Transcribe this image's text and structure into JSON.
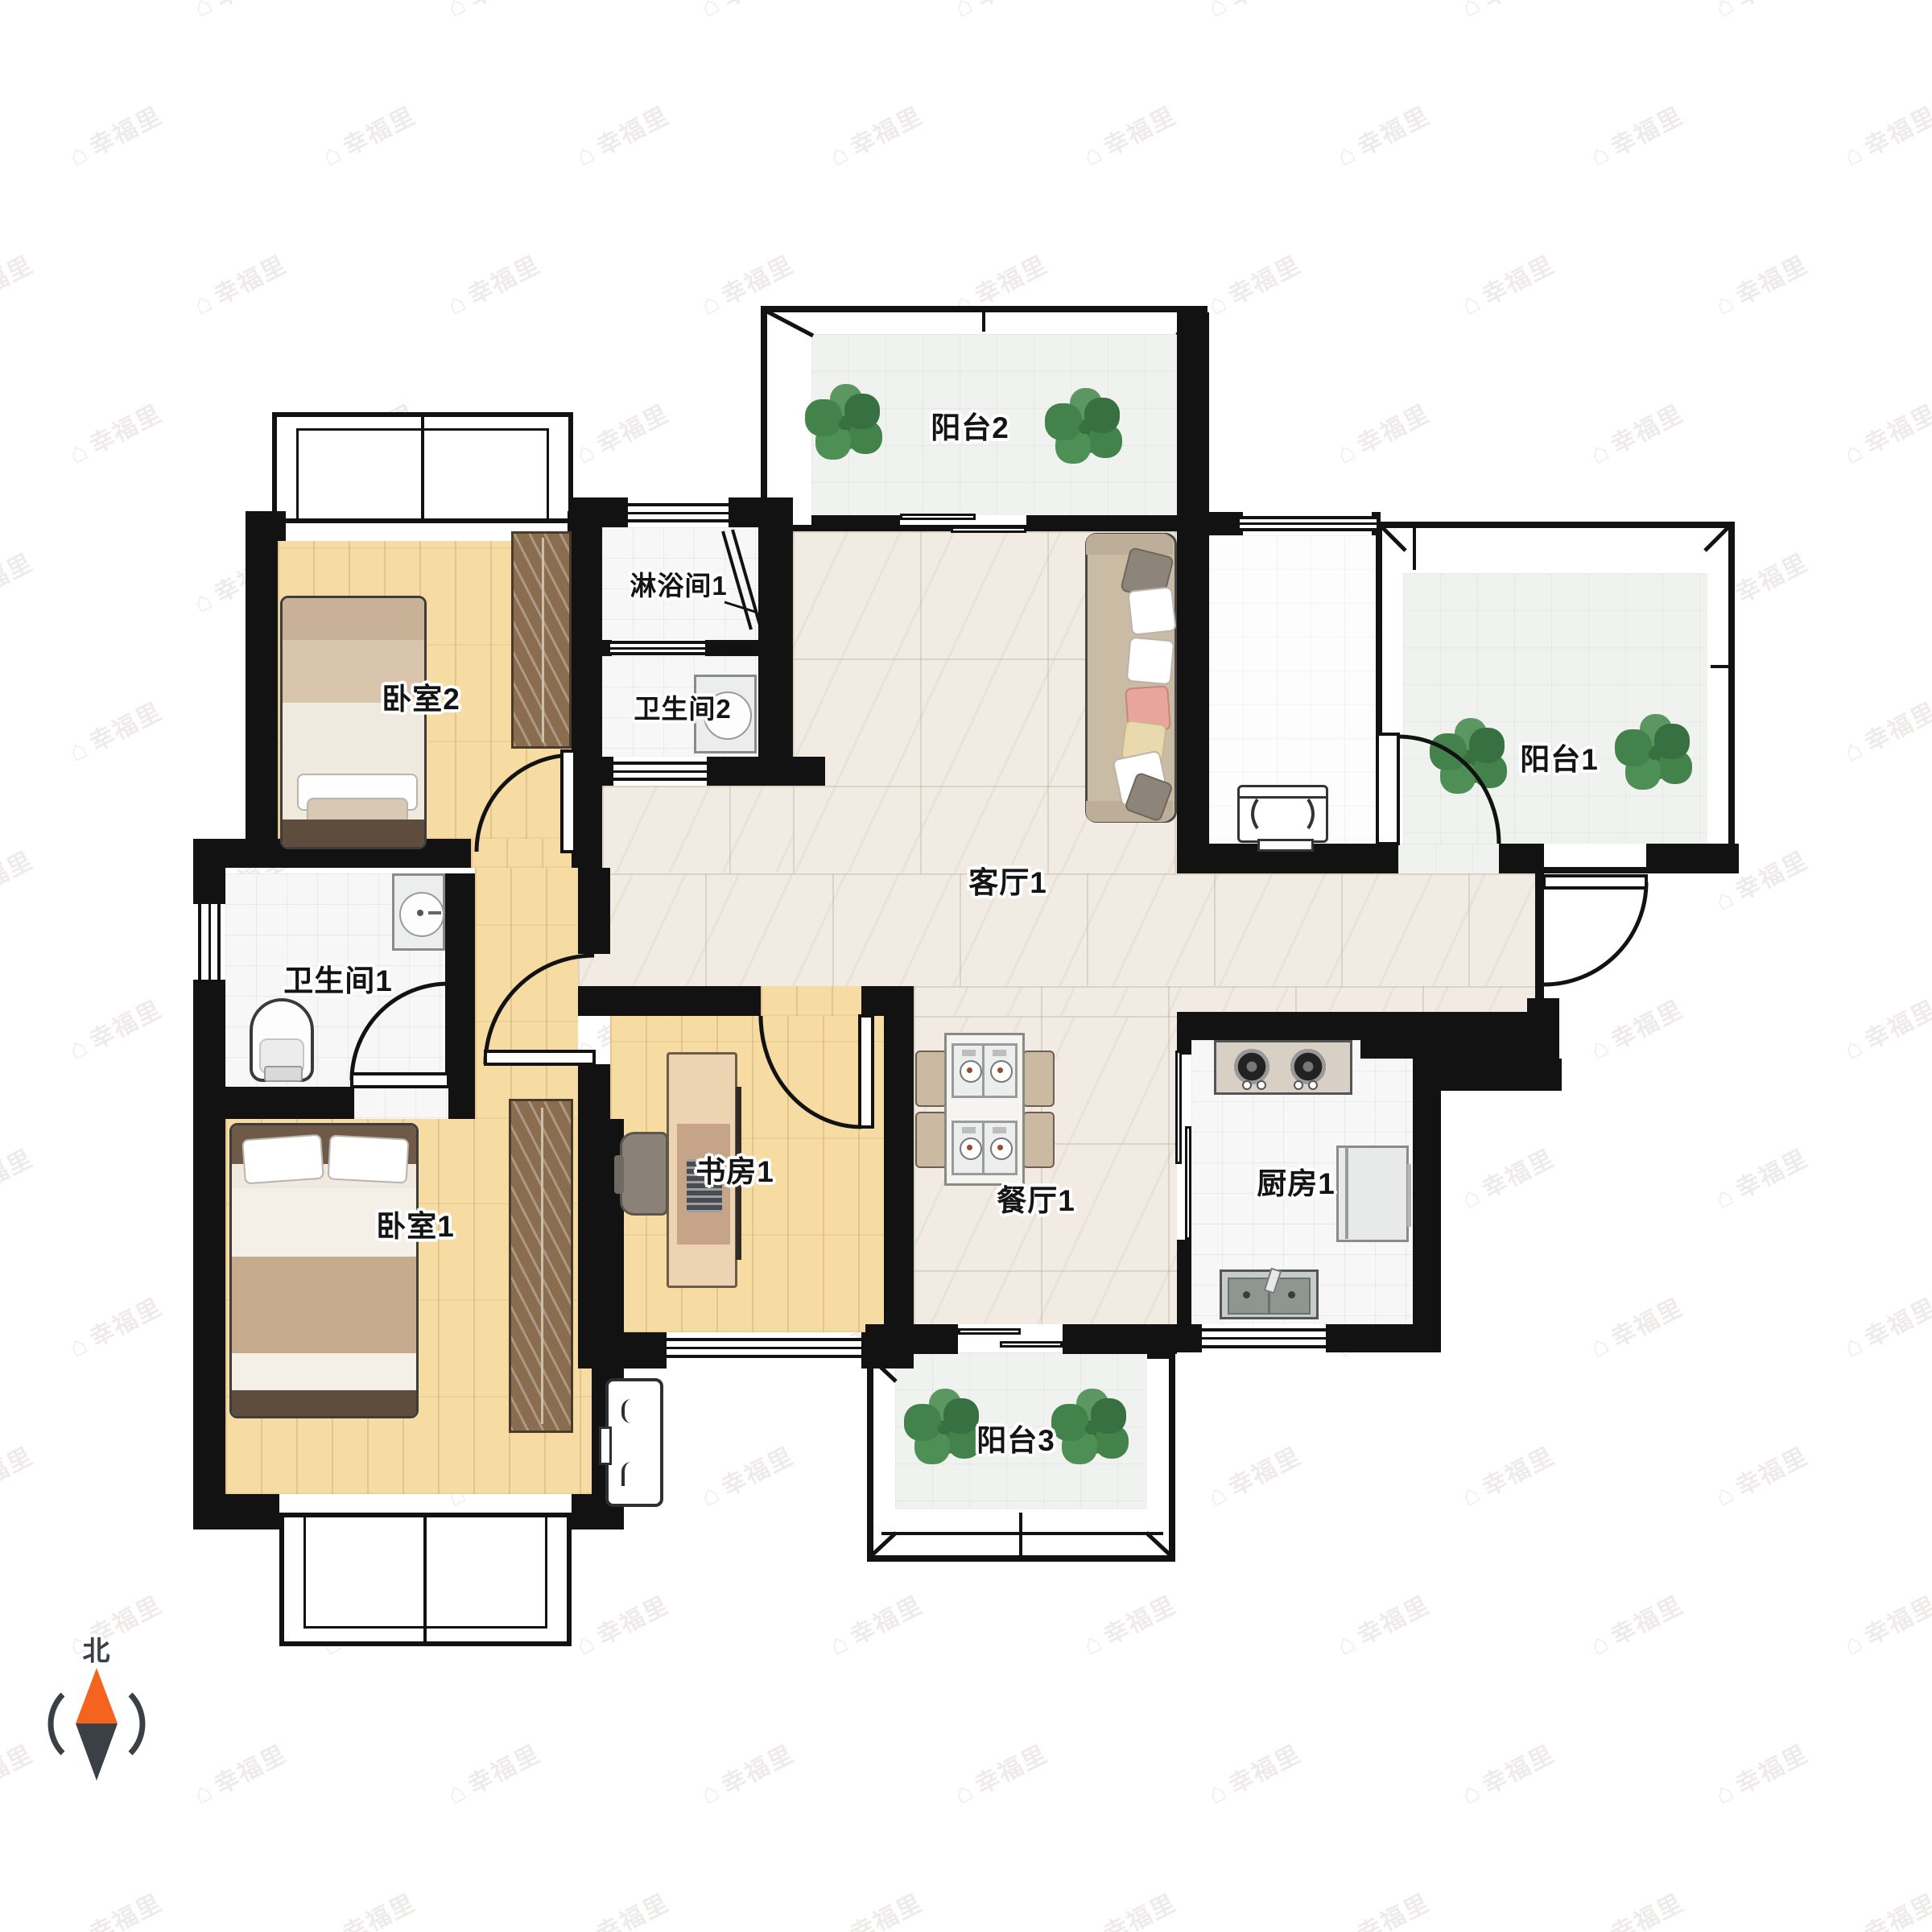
{
  "floorplan": {
    "watermark": {
      "text": "幸福里",
      "logo": "house-icon"
    },
    "compass": {
      "label": "北",
      "north_color": "#f4641e",
      "south_color": "#3b3f46"
    },
    "rooms": [
      {
        "id": "balcony2",
        "label": "阳台2"
      },
      {
        "id": "bedroom2",
        "label": "卧室2"
      },
      {
        "id": "shower1",
        "label": "淋浴间1"
      },
      {
        "id": "bathroom2",
        "label": "卫生间2"
      },
      {
        "id": "living1",
        "label": "客厅1"
      },
      {
        "id": "balcony1",
        "label": "阳台1"
      },
      {
        "id": "bathroom1",
        "label": "卫生间1"
      },
      {
        "id": "bedroom1",
        "label": "卧室1"
      },
      {
        "id": "study1",
        "label": "书房1"
      },
      {
        "id": "dining1",
        "label": "餐厅1"
      },
      {
        "id": "kitchen1",
        "label": "厨房1"
      },
      {
        "id": "balcony3",
        "label": "阳台3"
      }
    ],
    "colors": {
      "wall": "#121212",
      "wood_floor": "#f6dba3",
      "living_tile": "#f1ebe3",
      "balcony_tile": "#f0f2f0",
      "plant_green": "#3a7d42"
    },
    "furniture": [
      "sofa",
      "tv-stand",
      "double-bed",
      "single-bed",
      "wardrobe",
      "desk",
      "desk-chair",
      "dining-table",
      "stove",
      "fridge",
      "kitchen-sink",
      "toilet",
      "washbasin",
      "shower-screen",
      "ac-outdoor-unit",
      "plants"
    ]
  }
}
